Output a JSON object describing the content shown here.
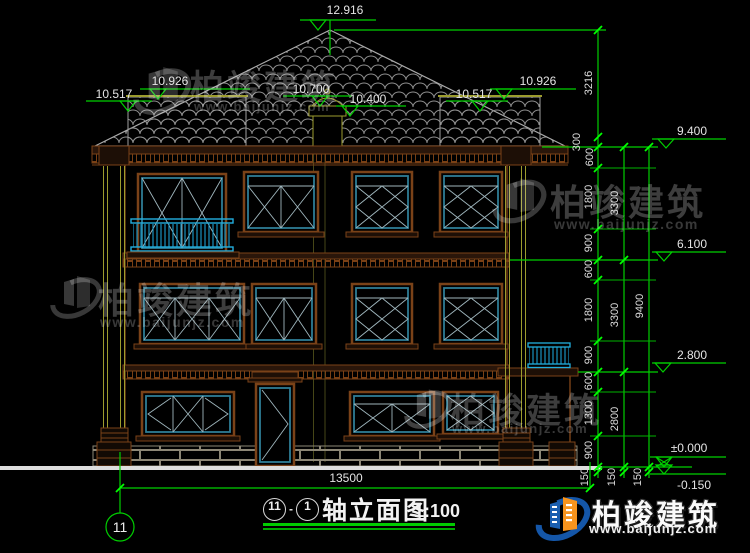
{
  "drawing": {
    "title": {
      "axis_start": "11",
      "separator": "-",
      "axis_end": "1",
      "name": "轴立面图",
      "scale": "1:100"
    },
    "axis_bubble_label": "11",
    "elevations": {
      "peak": "12.916",
      "left_outer": "10.517",
      "left_inner": "10.926",
      "ridge_left": "10.700",
      "ridge_right": "10.400",
      "right_outer": "10.517",
      "right_inner": "10.926",
      "eave": "9.400",
      "third_floor": "6.100",
      "second_floor": "2.800",
      "ground": "±0.000",
      "site": "-0.150"
    },
    "dimensions": {
      "column_inner": [
        "3216",
        "300",
        "600",
        "1800",
        "900",
        "600",
        "1800",
        "900",
        "600",
        "1300",
        "900",
        "150"
      ],
      "column_middle": [
        "3300",
        "3300",
        "2800",
        "150"
      ],
      "column_outer": [
        "9400",
        "150"
      ],
      "overall_width": "13500"
    }
  },
  "watermark": {
    "brand": "柏竣建筑",
    "url": "www.baijunjz.com"
  },
  "colors": {
    "annotation_green": "#00cf00",
    "tick_green": "#00ff00",
    "railing_cyan": "#22aede",
    "window_teal": "#2e7d95",
    "wall_brown": "#7a4218",
    "pilaster_olive": "#9c9c2e",
    "brand_blue": "#1456a8",
    "brand_orange": "#f7941d"
  }
}
